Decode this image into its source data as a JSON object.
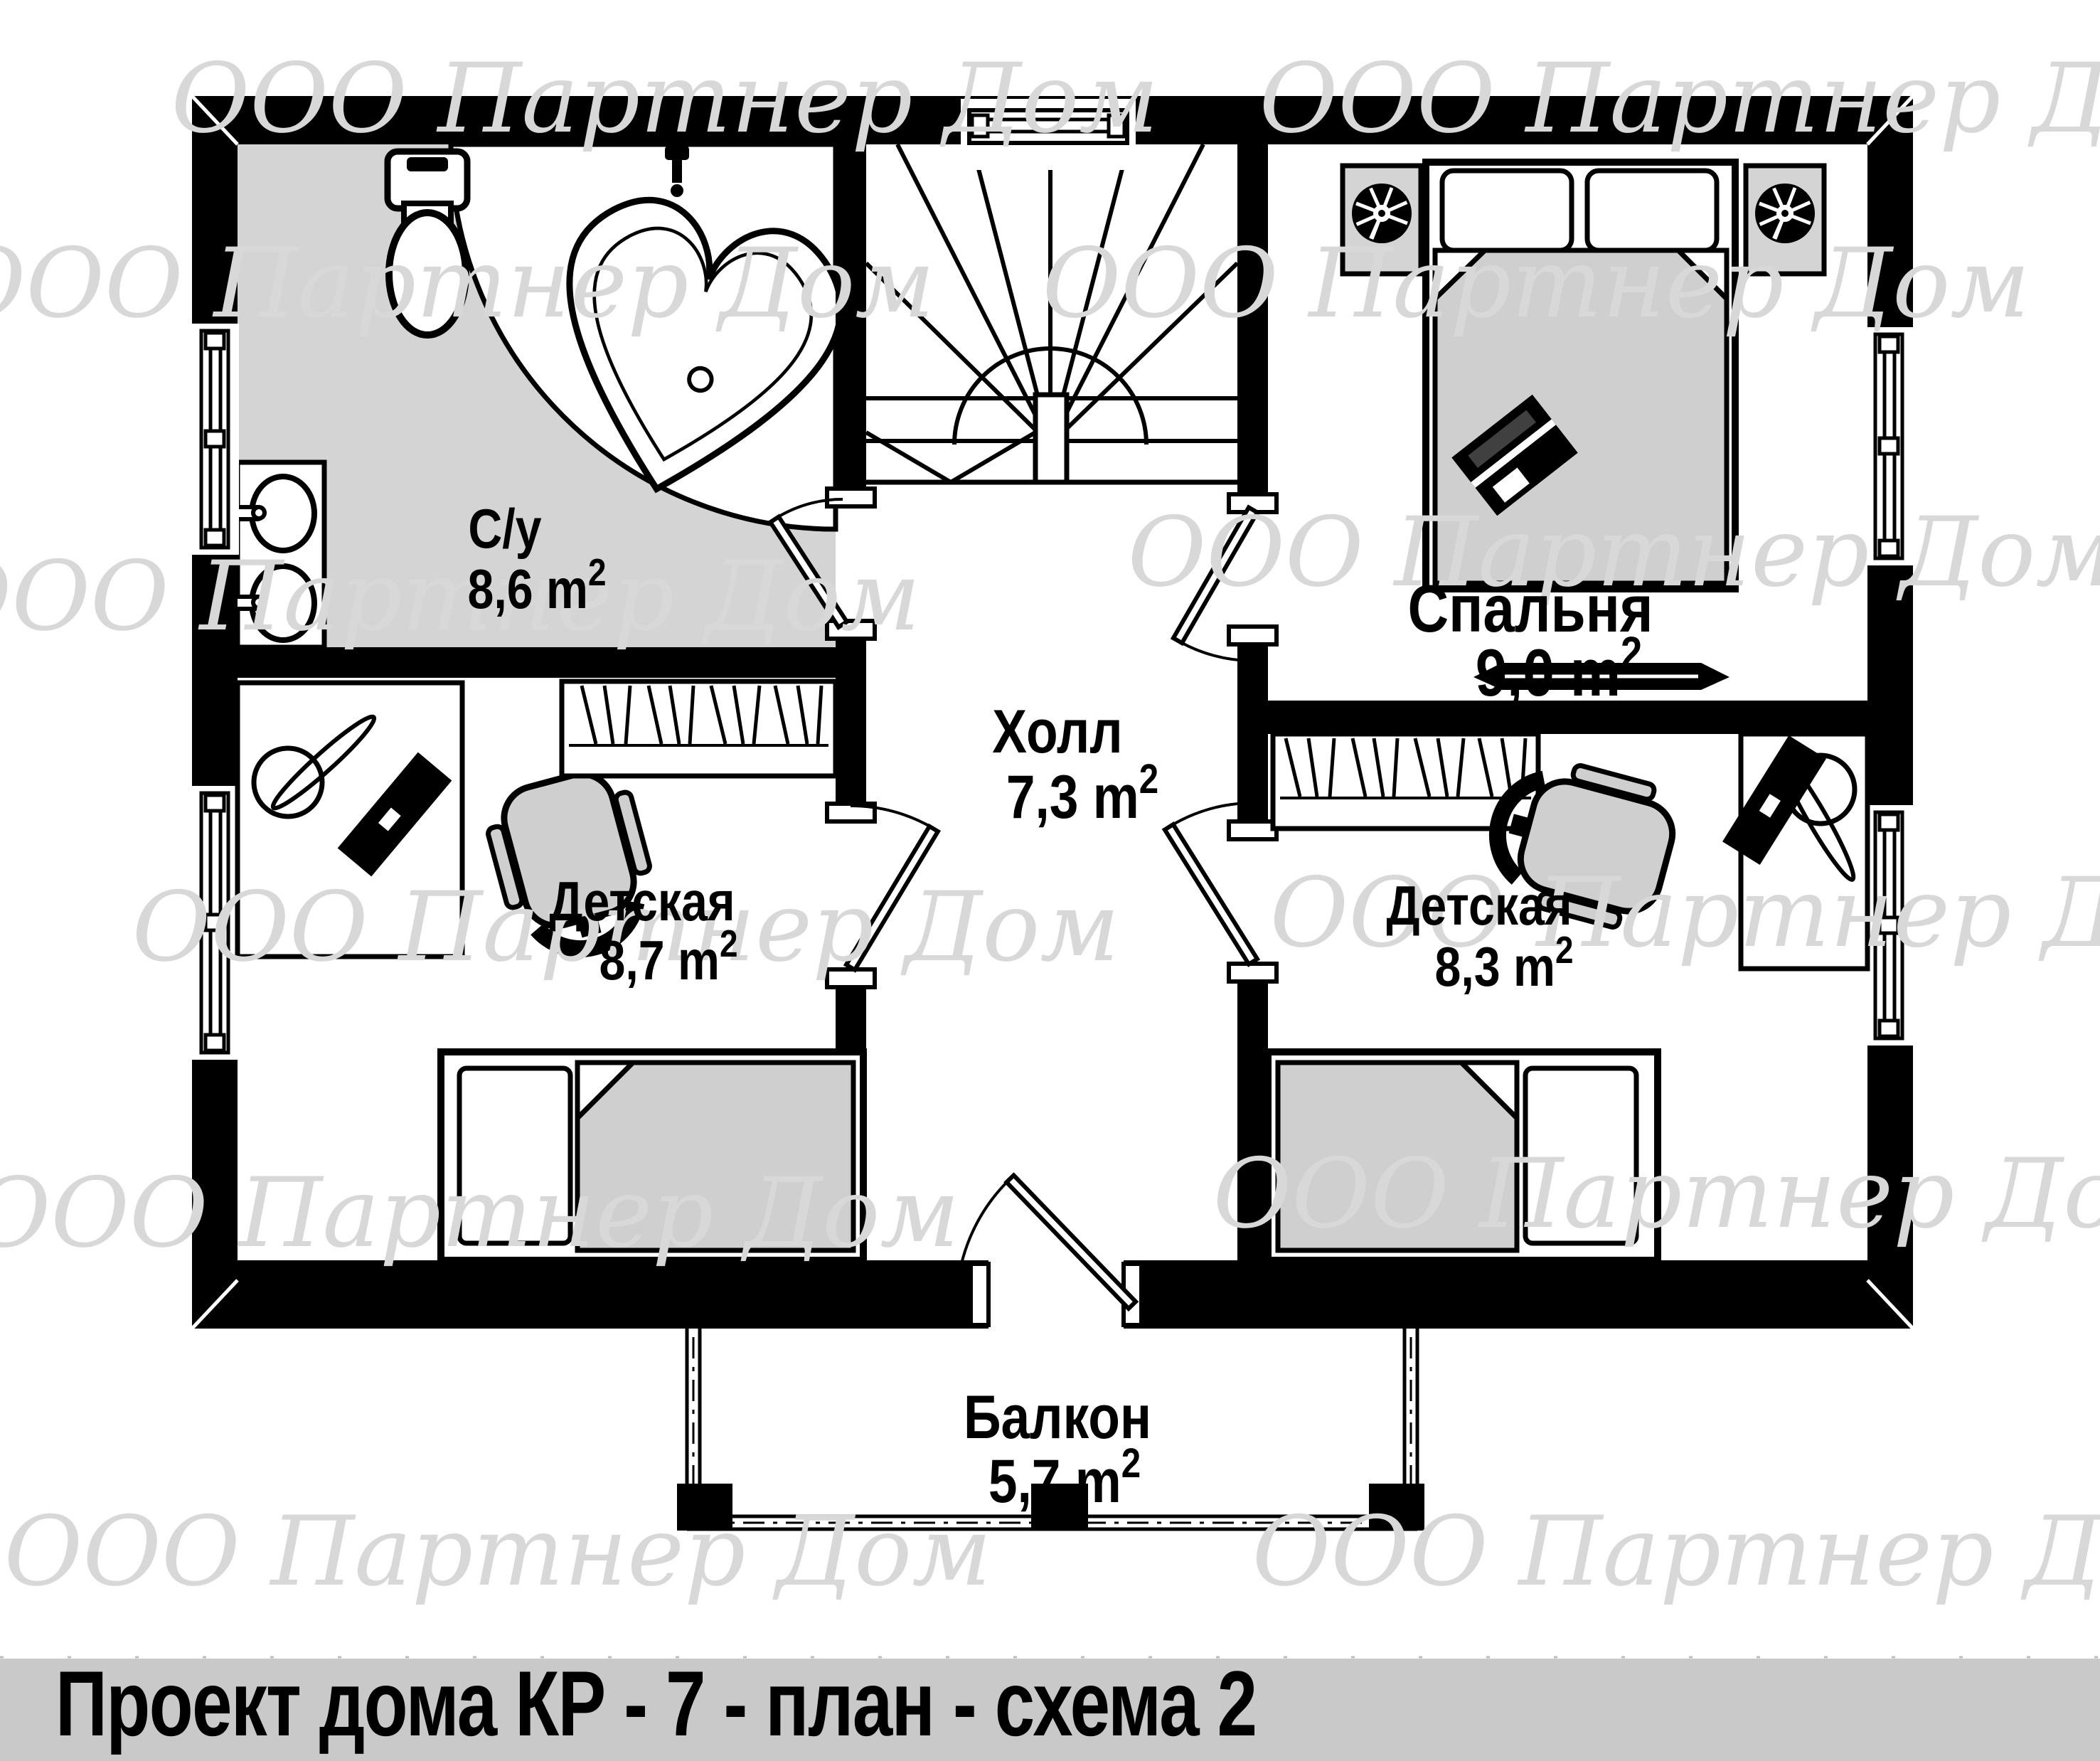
{
  "title_bar": {
    "text": "Проект дома КР - 7 - план - схема 2",
    "bg_color": "#c9c9c9",
    "text_color": "#000000"
  },
  "watermark": {
    "text": "ООО Партнер Дом",
    "color": "#d8d8d8"
  },
  "plan": {
    "wall_color": "#000000",
    "bathroom_floor_color": "#d4d4d4",
    "furniture_fill_color": "#cfcfcf",
    "rooms": [
      {
        "id": "bathroom",
        "name": "С/у",
        "area": "8,6 m",
        "area_sup": "2"
      },
      {
        "id": "bedroom",
        "name": "Спальня",
        "area": "9,0 m",
        "area_sup": "2"
      },
      {
        "id": "hall",
        "name": "Холл",
        "area": "7,3 m",
        "area_sup": "2"
      },
      {
        "id": "nursery-left",
        "name": "Детская",
        "area": "8,7 m",
        "area_sup": "2"
      },
      {
        "id": "nursery-right",
        "name": "Детская",
        "area": "8,3 m",
        "area_sup": "2"
      },
      {
        "id": "balcony",
        "name": "Балкон",
        "area": "5,7 m",
        "area_sup": "2"
      }
    ],
    "icons": [
      "toilet",
      "heart-bathtub",
      "double-sink",
      "winder-stairs",
      "window",
      "door-swing",
      "wardrobe-hangers",
      "single-bed",
      "double-bed",
      "pillow",
      "laptop",
      "desk",
      "desk-fan",
      "keyboard",
      "office-chair",
      "vent-fan",
      "wall-shelf",
      "balcony-railing"
    ]
  }
}
